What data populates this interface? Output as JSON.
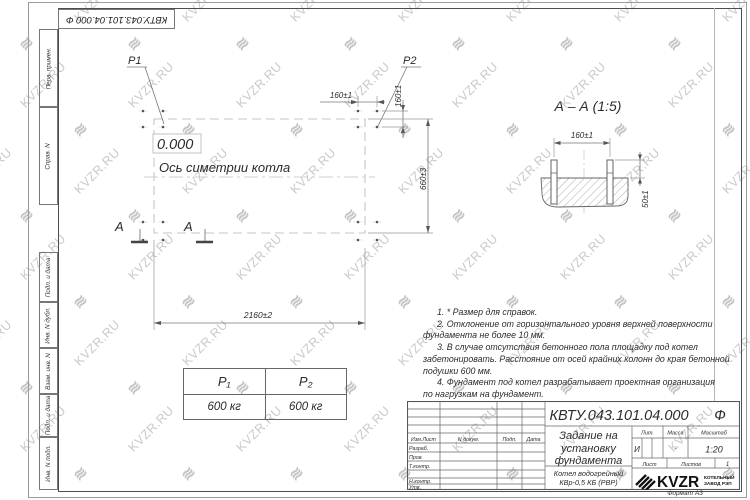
{
  "watermark": {
    "text": "KVZR.RU",
    "icon": "≋"
  },
  "corner_stamp": {
    "doc_number": "КВТУ.043.101.04.000 Ф"
  },
  "margin_labels": {
    "perv": "Перв. примен.",
    "sprav": "Справ. N",
    "podp1": "Подп. и дата",
    "inv_dubl": "Инв. N дубл.",
    "vzam": "Взам. инв. N",
    "podp2": "Подп. и дата",
    "inv_podl": "Инв. N подл."
  },
  "plan": {
    "p1_label": "P1",
    "p2_label": "P2",
    "elevation": "0.000",
    "axis_label": "Ось симетрии котла",
    "dim_top": "160±1",
    "dim_side": "160±1",
    "dim_right": "660±3",
    "dim_bottom": "2160±2",
    "section_letter_left": "А",
    "section_letter_right": "А"
  },
  "section": {
    "title": "А – А (1:5)",
    "dim_width": "160±1",
    "dim_height": "50±1"
  },
  "notes": {
    "lines": [
      "1. * Размер для справок.",
      "2. Отклонение от горизонтального уровня верхней поверхности",
      "фундамента не более 10 мм.",
      "3. В случае отсутствия бетонного пола площадку под котел",
      "забетонировать. Расстояние от осей крайних колонн до края бетонной",
      "подушки 600 мм.",
      "4. Фундамент под котел разрабатывает проектная организация",
      "по нагрузкам на фундамент."
    ]
  },
  "load_table": {
    "p1_header": "P₁",
    "p2_header": "P₂",
    "p1_value": "600 кг",
    "p2_value": "600 кг"
  },
  "title_block": {
    "doc_number": "КВТУ.043.101.04.000",
    "doc_suffix": "Ф",
    "doc_title_lines": [
      "Задание на",
      "установку",
      "фундамента"
    ],
    "product_lines": [
      "Котел водогрейный",
      "КВр-0,5 КБ (РВР)"
    ],
    "labels": {
      "izm_list": "Изм.Лист",
      "n_dokum": "N докум.",
      "podp": "Подп.",
      "data": "Дата",
      "razrab": "Разраб.",
      "prov": "Пров.",
      "t_kontr": "Т.контр.",
      "n_kontr": "Н.контр.",
      "utv": "Утв.",
      "lit": "Лит.",
      "massa": "Масса",
      "masshtab": "Масштаб",
      "list": "Лист",
      "listov": "Листов"
    },
    "values": {
      "lit": "И",
      "massa": "-",
      "masshtab": "1:20",
      "listov": "1"
    },
    "logo": {
      "text": "KVZR",
      "caption1": "КОТЕЛЬНЫЙ",
      "caption2": "ЗАВОД РЭП"
    },
    "format": "Формат А3"
  }
}
